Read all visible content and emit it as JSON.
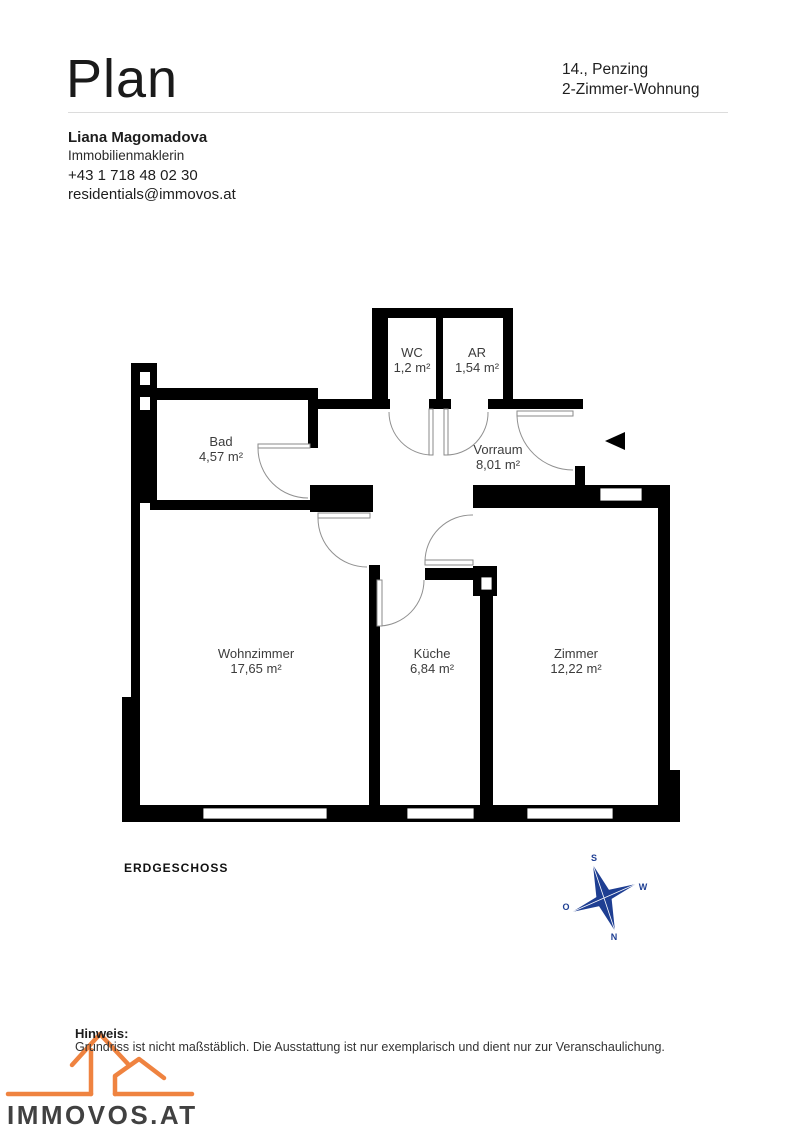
{
  "header": {
    "title": "Plan",
    "location_line1": "14., Penzing",
    "location_line2": "2-Zimmer-Wohnung"
  },
  "broker": {
    "name": "Liana Magomadova",
    "role": "Immobilienmaklerin",
    "phone": "+43 1 718 48 02 30",
    "email": "residentials@immovos.at"
  },
  "floorplan": {
    "floor_label": "ERDGESCHOSS",
    "rooms": [
      {
        "name": "WC",
        "area": "1,2 m²"
      },
      {
        "name": "AR",
        "area": "1,54 m²"
      },
      {
        "name": "Bad",
        "area": "4,57 m²"
      },
      {
        "name": "Vorraum",
        "area": "8,01 m²"
      },
      {
        "name": "Wohnzimmer",
        "area": "17,65 m²"
      },
      {
        "name": "Küche",
        "area": "6,84 m²"
      },
      {
        "name": "Zimmer",
        "area": "12,22 m²"
      }
    ],
    "compass": {
      "n": "N",
      "s": "S",
      "o": "O",
      "w": "W"
    }
  },
  "footer": {
    "note_label": "Hinweis:",
    "note_text": "Grundriss ist nicht maßstäblich. Die Ausstattung ist nur exemplarisch und dient nur zur Veranschaulichung.",
    "logo_text": "IMMOVOS.AT"
  },
  "colors": {
    "wall": "#000000",
    "compass_blue": "#1e3e92",
    "logo_orange": "#ef8340"
  }
}
